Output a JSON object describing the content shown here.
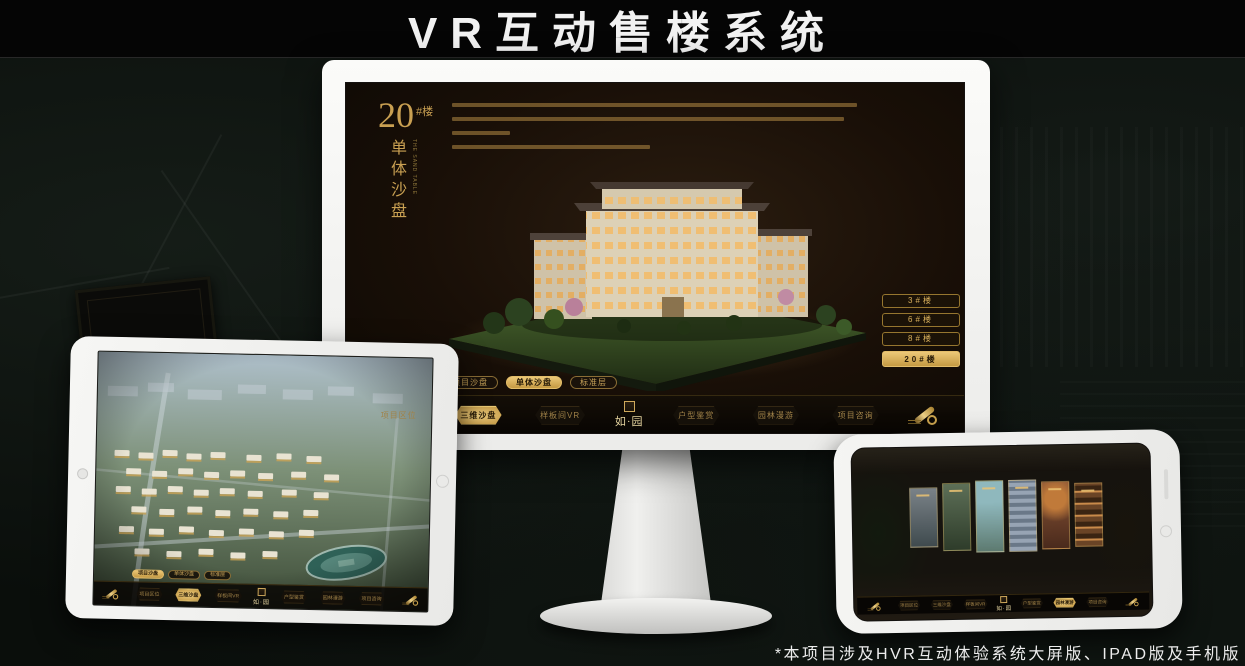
{
  "page": {
    "title": "VR互动售楼系统",
    "footnote": "*本项目涉及HVR互动体验系统大屏版、IPAD版及手机版"
  },
  "colors": {
    "gold": "#c9a050",
    "gold_bright": "#ecc878",
    "selected_text": "#241806",
    "screen_bg": "#190f07",
    "nav_bg": "#0b0805",
    "title_text": "#f2f2f2"
  },
  "icons": {
    "scroll": "scroll-icon",
    "seal": "seal-stamp-icon",
    "camera": "camera-icon",
    "home": "home-button-icon"
  },
  "monitor_screen": {
    "building_title": {
      "number": "20",
      "suffix": "#楼",
      "vertical": "单体沙盘",
      "vertical_en": "THE SAND TABLE"
    },
    "floor_buttons": [
      {
        "label": "3#楼",
        "selected": false
      },
      {
        "label": "6#楼",
        "selected": false
      },
      {
        "label": "8#楼",
        "selected": false
      },
      {
        "label": "20#楼",
        "selected": true
      }
    ],
    "sub_tabs": [
      {
        "label": "项目沙盘",
        "selected": false
      },
      {
        "label": "单体沙盘",
        "selected": true
      },
      {
        "label": "标准层",
        "selected": false
      }
    ],
    "nav": {
      "items": [
        {
          "label": "项目区位",
          "selected": false
        },
        {
          "label": "三维沙盘",
          "selected": true
        },
        {
          "label": "样板间VR",
          "selected": false
        },
        {
          "label": "户型鉴赏",
          "selected": false
        },
        {
          "label": "园林漫游",
          "selected": false
        },
        {
          "label": "项目咨询",
          "selected": false
        }
      ],
      "logo": "如·园"
    }
  },
  "tablet_screen": {
    "sub_tabs": [
      {
        "label": "项目沙盘",
        "selected": true
      },
      {
        "label": "单体沙盘",
        "selected": false
      },
      {
        "label": "标准层",
        "selected": false
      }
    ],
    "nav": {
      "items": [
        {
          "label": "项目区位",
          "selected": false
        },
        {
          "label": "三维沙盘",
          "selected": true
        },
        {
          "label": "样板间VR",
          "selected": false
        },
        {
          "label": "户型鉴赏",
          "selected": false
        },
        {
          "label": "园林漫游",
          "selected": false
        },
        {
          "label": "项目咨询",
          "selected": false
        }
      ],
      "logo": "如·园"
    }
  },
  "phone_screen": {
    "nav": {
      "items": [
        {
          "label": "项目区位",
          "selected": false
        },
        {
          "label": "三维沙盘",
          "selected": false
        },
        {
          "label": "样板间VR",
          "selected": false
        },
        {
          "label": "户型鉴赏",
          "selected": false
        },
        {
          "label": "园林漫游",
          "selected": true
        },
        {
          "label": "项目咨询",
          "selected": false
        }
      ],
      "logo": "如·园"
    }
  }
}
